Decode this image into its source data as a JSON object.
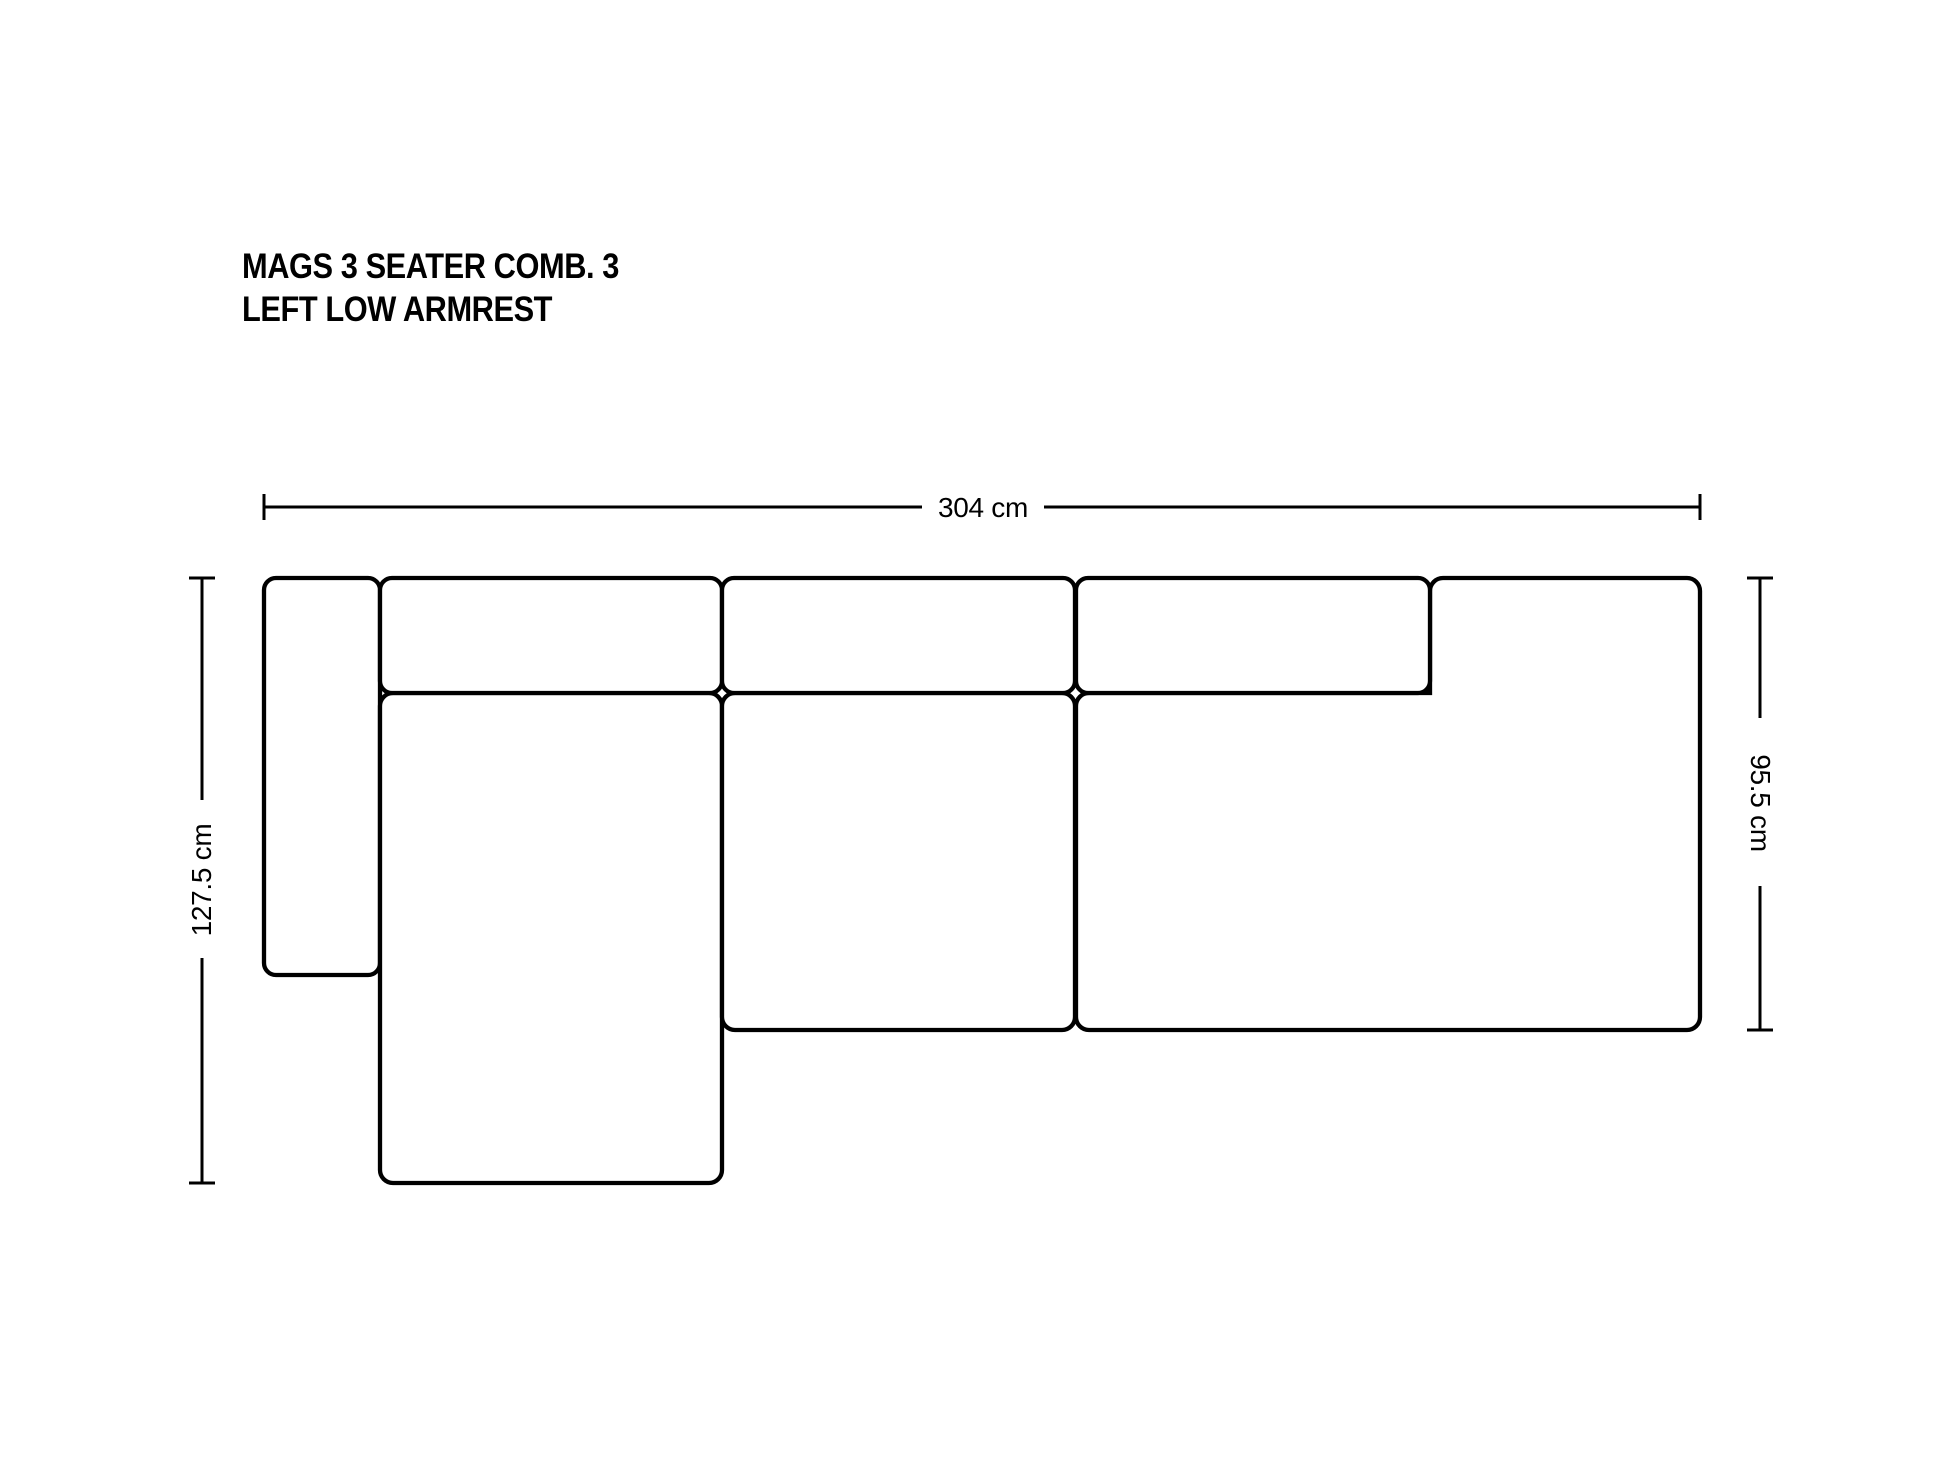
{
  "page": {
    "background_color": "#ffffff",
    "ink_color": "#000000"
  },
  "title": {
    "line1": "MAGS 3 SEATER COMB. 3",
    "line2": "LEFT LOW ARMREST"
  },
  "dimensions": {
    "width": {
      "label": "304 cm",
      "value_cm": 304
    },
    "left_depth": {
      "label": "127.5 cm",
      "value_cm": 127.5
    },
    "right_depth": {
      "label": "95.5 cm",
      "value_cm": 95.5
    }
  },
  "drawing": {
    "unit": "px",
    "shapes": [
      {
        "name": "left-low-armrest",
        "type": "rect",
        "x": 264,
        "y": 578,
        "w": 116,
        "h": 397,
        "r": 12
      },
      {
        "name": "chaise-seat",
        "type": "rect",
        "x": 380,
        "y": 693,
        "w": 342,
        "h": 490,
        "r": 13
      },
      {
        "name": "middle-seat",
        "type": "rect",
        "x": 722,
        "y": 693,
        "w": 353,
        "h": 337,
        "r": 13
      },
      {
        "name": "right-seat",
        "type": "path",
        "d": "M 1089 693 L 1430 693 L 1430 591 A 13 13 0 0 1 1443 578 L 1687 578 A 13 13 0 0 1 1700 591 L 1700 1017 A 13 13 0 0 1 1687 1030 L 1089 1030 A 13 13 0 0 1 1076 1017 L 1076 706 A 13 13 0 0 1 1089 693 Z"
      },
      {
        "name": "backrest-cushion-1",
        "type": "rect",
        "x": 380,
        "y": 578,
        "w": 342,
        "h": 115,
        "r": 12
      },
      {
        "name": "backrest-cushion-2",
        "type": "rect",
        "x": 722,
        "y": 578,
        "w": 353,
        "h": 115,
        "r": 12
      },
      {
        "name": "backrest-cushion-3",
        "type": "rect",
        "x": 1076,
        "y": 578,
        "w": 354,
        "h": 115,
        "r": 12
      }
    ],
    "dimension_lines": [
      {
        "name": "width-dimension-line",
        "segments": [
          [
            264,
            507,
            922,
            507
          ],
          [
            1044,
            507,
            1700,
            507
          ]
        ],
        "ticks": [
          [
            264,
            494,
            264,
            520
          ],
          [
            1700,
            494,
            1700,
            520
          ]
        ]
      },
      {
        "name": "left-depth-dimension-line",
        "segments": [
          [
            202,
            578,
            202,
            800
          ],
          [
            202,
            958,
            202,
            1183
          ]
        ],
        "ticks": [
          [
            189,
            578,
            215,
            578
          ],
          [
            189,
            1183,
            215,
            1183
          ]
        ]
      },
      {
        "name": "right-depth-dimension-line",
        "segments": [
          [
            1760,
            578,
            1760,
            718
          ],
          [
            1760,
            886,
            1760,
            1030
          ]
        ],
        "ticks": [
          [
            1747,
            578,
            1773,
            578
          ],
          [
            1747,
            1030,
            1773,
            1030
          ]
        ]
      }
    ]
  }
}
